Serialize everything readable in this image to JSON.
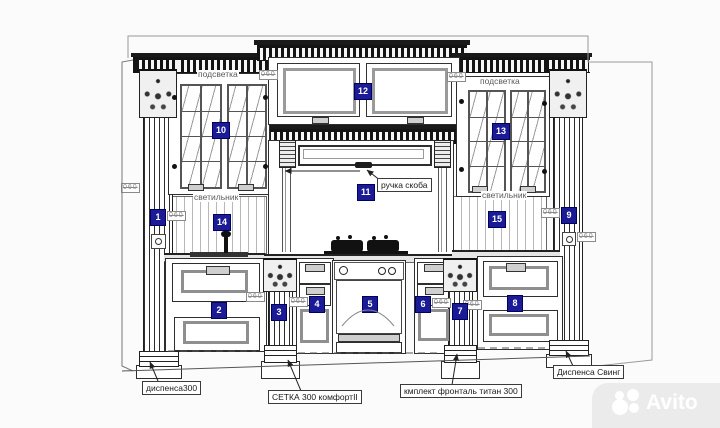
{
  "watermark": {
    "brand": "Avito"
  },
  "labels": {
    "backlight_left": "подсветка",
    "backlight_right": "подсветка",
    "light_left": "светильник",
    "light_right": "светильник"
  },
  "boxed_labels": {
    "handle_bracket": "ручка скоба",
    "dispenser_300": "диспенса300",
    "mesh_300": "СЕТКА 300 комфортII",
    "front_set_titan_300": "кмплект фронталь титан 300",
    "dispenser_swing": "Диспенса Свинг"
  },
  "dim_tag": {
    "text": "060"
  },
  "callouts": [
    {
      "number": "1"
    },
    {
      "number": "2"
    },
    {
      "number": "3"
    },
    {
      "number": "4"
    },
    {
      "number": "5"
    },
    {
      "number": "6"
    },
    {
      "number": "7"
    },
    {
      "number": "8"
    },
    {
      "number": "9"
    },
    {
      "number": "10"
    },
    {
      "number": "11"
    },
    {
      "number": "12"
    },
    {
      "number": "13"
    },
    {
      "number": "14"
    },
    {
      "number": "15"
    }
  ],
  "colors": {
    "callout_bg": "#1b1b96",
    "callout_text": "#ffffff",
    "line": "#1a1a1a",
    "dim_tag": "#8a8a8a",
    "watermark_bg": "#ebebeb",
    "watermark_text": "#ffffff"
  }
}
